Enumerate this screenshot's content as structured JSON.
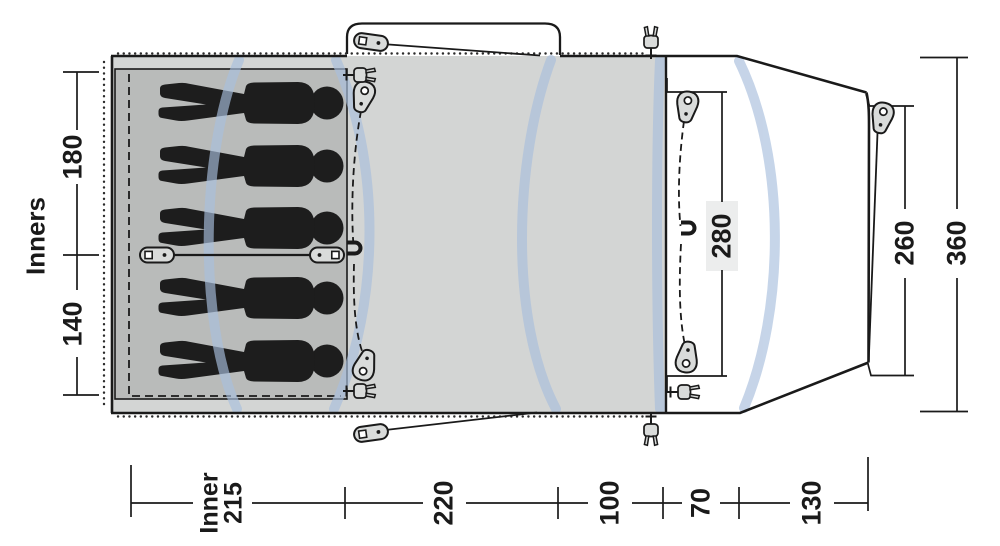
{
  "diagram": {
    "kind": "tent-floorplan-top-view",
    "scales": {
      "left": {
        "title": "Inners",
        "dims": [
          "180",
          "140"
        ]
      },
      "bottom": {
        "inner_label": "Inner",
        "dims": [
          "215",
          "220",
          "100",
          "70",
          "130"
        ]
      },
      "right": {
        "dims": [
          "280",
          "260",
          "360"
        ]
      }
    },
    "areas": {
      "inner_tent": {
        "people_count": 5,
        "compartment_split": "3 + 2",
        "floor_color": "#b9bbba"
      },
      "living_area": {
        "floor_color": "#d3d5d4"
      },
      "porch": {
        "floor_color": "#ffffff",
        "shape": "tapered-front"
      }
    },
    "elements": {
      "pole_arcs": 5,
      "pole_color": "#a9bfdd",
      "pegs_teardrop": 5,
      "toggle_sliders": 4,
      "plugs": 5,
      "magnets": 2,
      "dashed_door_lines": 2,
      "awning_canopy": 1,
      "outline_color": "#1a1a1a",
      "label_badge_color": "#eceded"
    }
  },
  "scales": {
    "left": {
      "title": "Inners",
      "dims": [
        "180",
        "140"
      ]
    },
    "bottom": {
      "inner_label": "Inner",
      "dims": [
        "215",
        "220",
        "100",
        "70",
        "130"
      ]
    },
    "right": {
      "dims": [
        "280",
        "260",
        "360"
      ]
    }
  }
}
